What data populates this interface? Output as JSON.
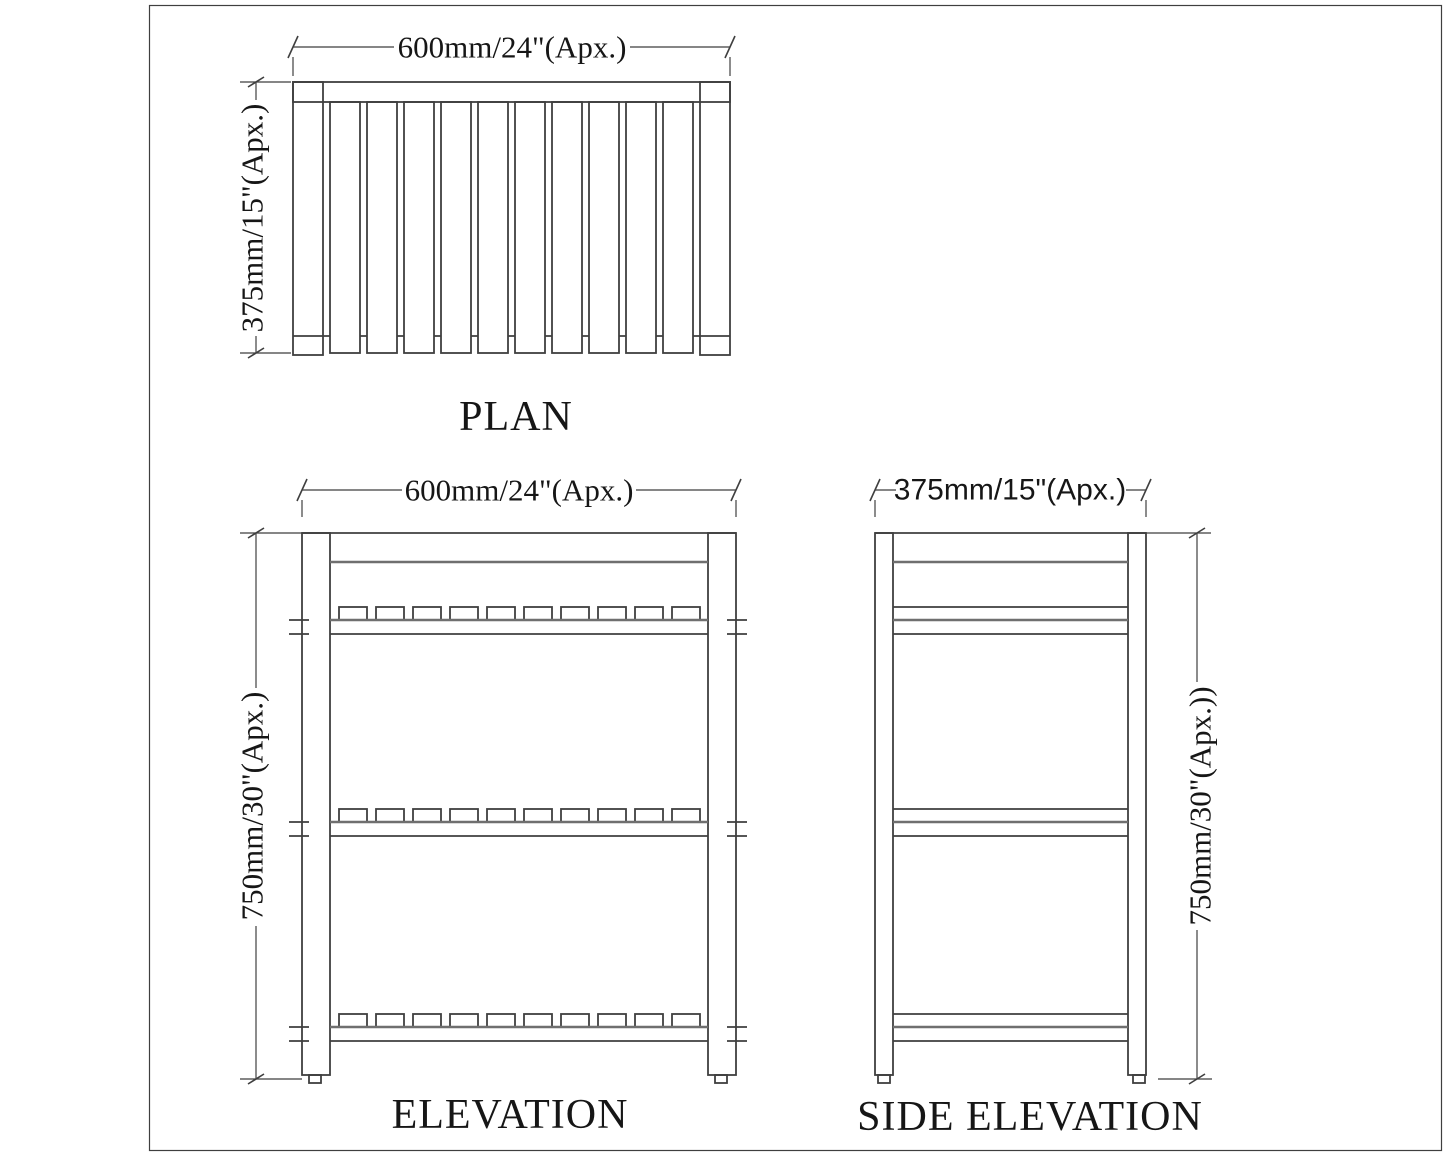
{
  "sheet": {
    "colors": {
      "line": "#3f3f3f",
      "line_soft": "#6f6f6f",
      "text": "#161616",
      "background": "#ffffff"
    },
    "plan": {
      "title": "PLAN",
      "width_dim": "600mm/24\"(Apx.)",
      "depth_dim": "375mm/15\"(Apx.)"
    },
    "elevation": {
      "title": "ELEVATION",
      "width_dim": "600mm/24\"(Apx.)",
      "height_dim": "750mm/30\"(Apx.)"
    },
    "side_elevation": {
      "title": "SIDE ELEVATION",
      "width_dim": "375mm/15\"(Apx.)",
      "height_dim": "750mm/30\"(Apx.))"
    }
  }
}
